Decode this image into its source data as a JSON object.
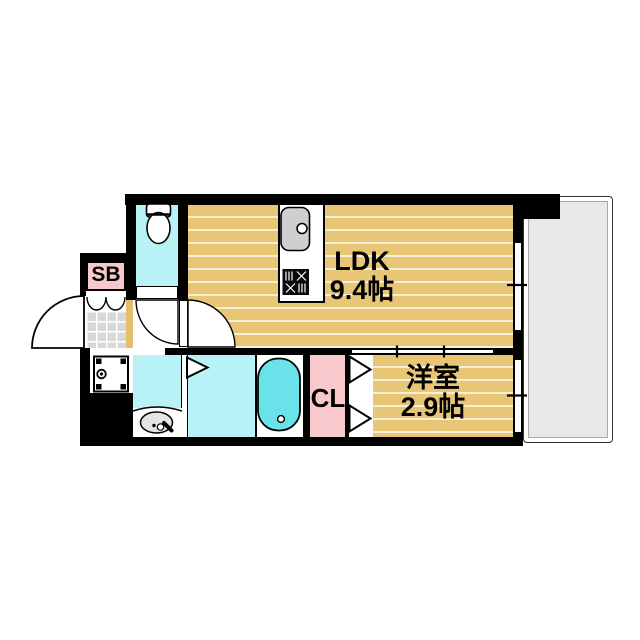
{
  "floor_plan": {
    "rooms": {
      "ldk": {
        "label": "LDK",
        "area": "9.4帖"
      },
      "western_room": {
        "label": "洋室",
        "area": "2.9帖"
      },
      "closet": {
        "label": "CL"
      },
      "shoe_box": {
        "label": "SB"
      }
    },
    "colors": {
      "wood_floor": "#e9c675",
      "wet_area_floor": "#b9f2f6",
      "bathtub": "#69e3e9",
      "accent_pink": "#f8c9cc",
      "entrance_tile": "#d8d8d8",
      "balcony": "#e8e8e8",
      "wall": "#000000"
    }
  }
}
